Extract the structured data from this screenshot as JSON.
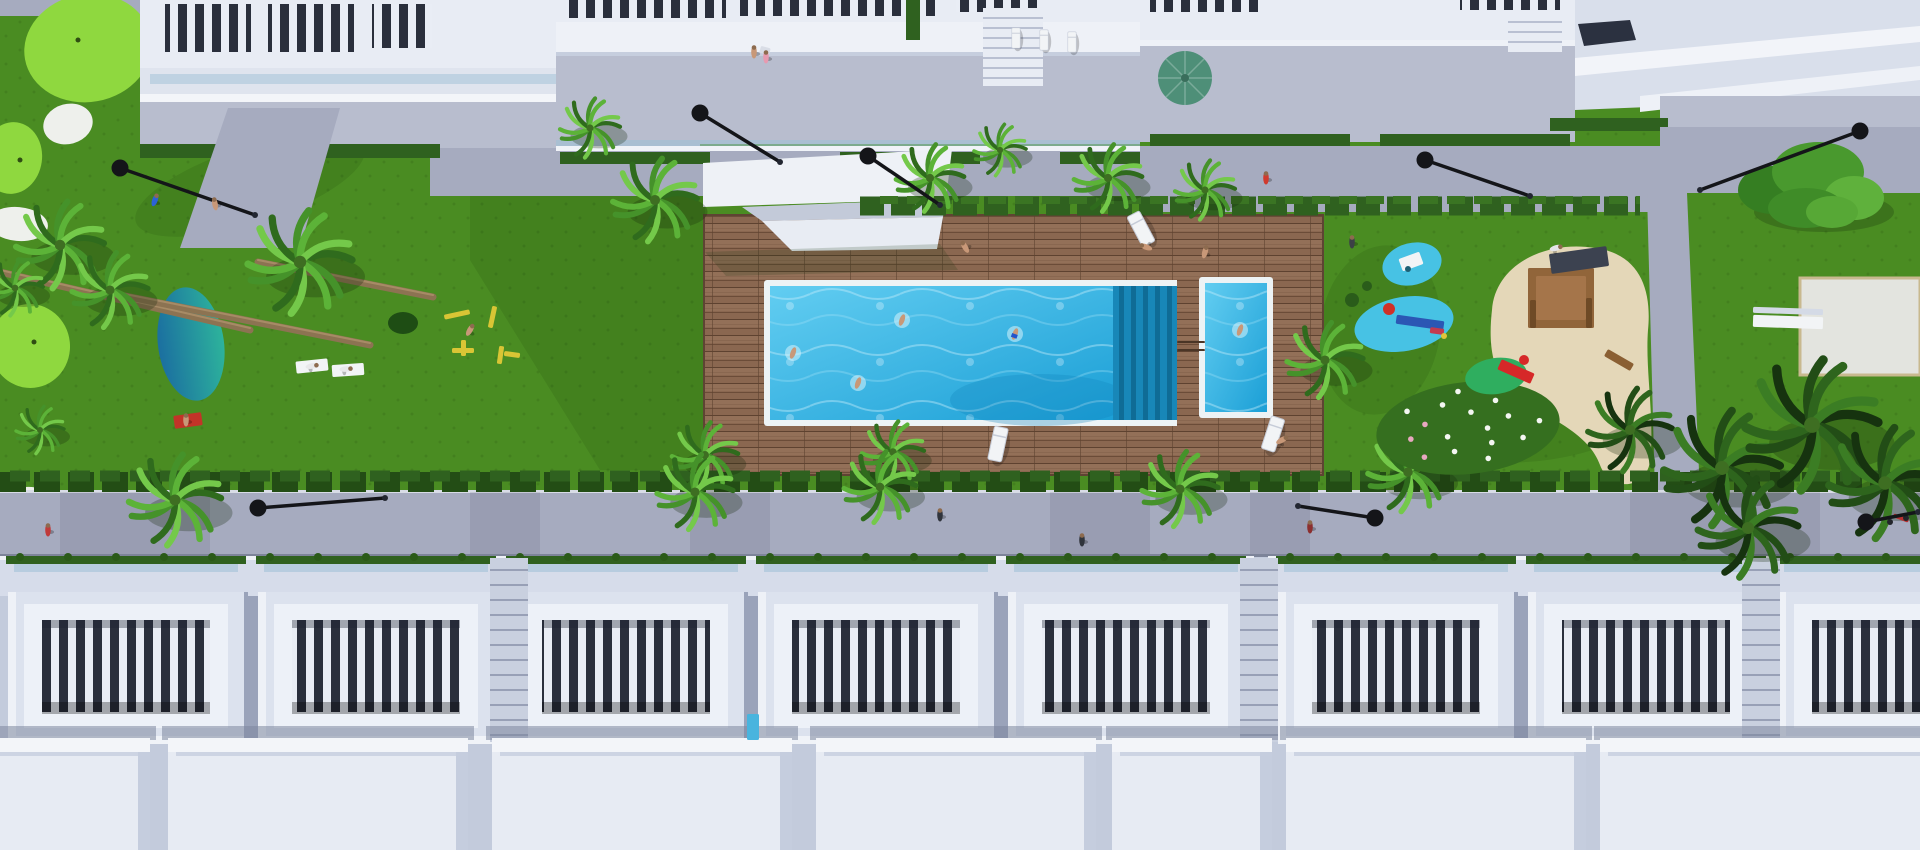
{
  "scene": {
    "description": "Aerial 3D architectural rendering of a white residential resort complex: communal lap pool and kids pool on a wooden deck, lawns with mini-golf, pond, playgrounds, palm trees, street lamps, and rows of townhouse roof terraces",
    "palette": {
      "grass": "#4a8c22",
      "grassDot": "#3c7419",
      "golf": "#8fd83f",
      "golfHole": "#2f4d12",
      "sandWhite": "#eef0ec",
      "pondA": "#2ba898",
      "pondB": "#176e9e",
      "pool": "#2fb0e4",
      "poolDeep": "#1286bd",
      "poolLight": "#aee4f6",
      "rim": "#edf3f5",
      "wood": "#8a6750",
      "woodDark": "#6b4c38",
      "woodLight": "#9c7a60",
      "hedge": "#2f611f",
      "hedgeDark": "#234d15",
      "pave": "#a6abbf",
      "paveLight": "#b8bdce",
      "paveShade": "#8a90a6",
      "bldg": "#e8ecf4",
      "bldgShade": "#c9d0e1",
      "bldgDark": "#99a2ba",
      "slot": "#2a2f3c",
      "glass": "#9fc0d6",
      "sand": "#e4d7b8",
      "woodStruct": "#91653a",
      "lamp": "#141519",
      "umbrella": "#4e8f78",
      "splash": "#47c2e4",
      "mound": "#2fae5f",
      "slide": "#d62828",
      "skin": "#c89878",
      "white": "#f2f4f6",
      "yellow": "#d9c535",
      "red": "#c43a2e"
    },
    "golf": {
      "patches": [
        {
          "x": 88,
          "y": 48,
          "rx": 64,
          "ry": 54,
          "rot": -10
        },
        {
          "x": 12,
          "y": 158,
          "rx": 30,
          "ry": 36,
          "rot": 8
        },
        {
          "x": 30,
          "y": 346,
          "rx": 40,
          "ry": 42,
          "rot": -6
        }
      ],
      "bunkers": [
        {
          "x": 68,
          "y": 124,
          "rx": 25,
          "ry": 20,
          "rot": -15
        },
        {
          "x": 190,
          "y": 98,
          "rx": 33,
          "ry": 22,
          "rot": -8
        },
        {
          "x": 18,
          "y": 224,
          "rx": 30,
          "ry": 17,
          "rot": 5
        },
        {
          "x": 26,
          "y": 502,
          "rx": 27,
          "ry": 15,
          "rot": -4
        }
      ],
      "holes": [
        [
          78,
          40
        ],
        [
          20,
          160
        ],
        [
          34,
          342
        ]
      ]
    },
    "pond": {
      "x": 191,
      "y": 344,
      "rx": 33,
      "ry": 57,
      "rot": -8
    },
    "trunks": [
      [
        0,
        272,
        250,
        330
      ],
      [
        120,
        295,
        370,
        345
      ],
      [
        258,
        262,
        433,
        297
      ]
    ],
    "palms": [
      [
        590,
        128,
        30,
        0
      ],
      [
        655,
        200,
        42,
        0
      ],
      [
        930,
        178,
        34,
        0
      ],
      [
        1000,
        150,
        26,
        0
      ],
      [
        1108,
        178,
        34,
        0
      ],
      [
        1205,
        190,
        30,
        0
      ],
      [
        60,
        245,
        44,
        0
      ],
      [
        110,
        290,
        38,
        0
      ],
      [
        300,
        262,
        52,
        0
      ],
      [
        15,
        288,
        28,
        0
      ],
      [
        40,
        430,
        24,
        0
      ],
      [
        705,
        455,
        33,
        0
      ],
      [
        893,
        452,
        31,
        0
      ],
      [
        1325,
        360,
        38,
        0
      ],
      [
        175,
        500,
        46,
        0
      ],
      [
        695,
        492,
        38,
        0
      ],
      [
        880,
        487,
        36,
        0
      ],
      [
        1180,
        489,
        38,
        0
      ],
      [
        1408,
        472,
        40,
        0
      ],
      [
        1630,
        430,
        42,
        1
      ],
      [
        1722,
        468,
        58,
        1
      ],
      [
        1812,
        425,
        66,
        1
      ],
      [
        1885,
        483,
        56,
        1
      ],
      [
        1748,
        528,
        50,
        1
      ]
    ],
    "trees": [
      [
        1810,
        182
      ]
    ],
    "flowerBush": {
      "x": 1468,
      "y": 428,
      "rx": 92,
      "ry": 46,
      "dots": 16
    },
    "lamps": [
      [
        120,
        168,
        255,
        215
      ],
      [
        700,
        113,
        780,
        162
      ],
      [
        868,
        156,
        940,
        205
      ],
      [
        1425,
        160,
        1530,
        196
      ],
      [
        1860,
        131,
        1700,
        190
      ],
      [
        258,
        508,
        385,
        498
      ],
      [
        1375,
        518,
        1298,
        506
      ],
      [
        1866,
        522,
        1918,
        512
      ]
    ],
    "loungers": [
      [
        1141,
        229,
        -28,
        1
      ],
      [
        1273,
        434,
        18,
        1
      ],
      [
        998,
        444,
        12,
        1
      ],
      [
        1016,
        38,
        0,
        0.6
      ],
      [
        1044,
        40,
        0,
        0.6
      ],
      [
        1072,
        42,
        0,
        0.6
      ]
    ],
    "people": [
      [
        155,
        200,
        "#2c62d6",
        20
      ],
      [
        215,
        204,
        "skin",
        -10
      ],
      [
        312,
        366,
        "#e8e8ea",
        80
      ],
      [
        346,
        369,
        "#e8e8ea",
        85
      ],
      [
        186,
        420,
        "skin",
        0
      ],
      [
        470,
        330,
        "skin",
        30
      ],
      [
        754,
        52,
        "skin",
        0
      ],
      [
        766,
        57,
        "#e79ab0",
        0
      ],
      [
        965,
        247,
        "skin",
        -30
      ],
      [
        1205,
        252,
        "skin",
        15
      ],
      [
        1146,
        247,
        "skin",
        -70
      ],
      [
        1282,
        440,
        "skin",
        60
      ],
      [
        1352,
        242,
        "#3c4046",
        0
      ],
      [
        1556,
        248,
        "#e4e4e8",
        75
      ],
      [
        1266,
        178,
        "#d03a2e",
        0
      ],
      [
        940,
        515,
        "#30343c",
        0
      ],
      [
        1082,
        540,
        "#30343c",
        0
      ],
      [
        1310,
        527,
        "#8c2f2f",
        0
      ],
      [
        48,
        530,
        "#c03a3a",
        0
      ]
    ],
    "swimmers": [
      [
        902,
        320,
        0
      ],
      [
        1015,
        334,
        "#2255cc"
      ],
      [
        793,
        353,
        0
      ],
      [
        858,
        383,
        0
      ],
      [
        1240,
        330,
        0
      ]
    ],
    "props": [
      {
        "t": "ellipse",
        "x": 1412,
        "y": 264,
        "rx": 30,
        "ry": 21,
        "r": -14,
        "f": "splash"
      },
      {
        "t": "rect",
        "x": 1400,
        "y": 255,
        "w": 22,
        "h": 13,
        "r": -20,
        "f": "white"
      },
      {
        "t": "circle",
        "x": 1408,
        "y": 269,
        "rad": 3,
        "f": "#1d5f74"
      },
      {
        "t": "ellipse",
        "x": 1404,
        "y": 324,
        "rx": 50,
        "ry": 27,
        "r": -10,
        "f": "splash"
      },
      {
        "t": "rect",
        "x": 1396,
        "y": 318,
        "w": 48,
        "h": 9,
        "r": 8,
        "f": "#2b57b4"
      },
      {
        "t": "circle",
        "x": 1389,
        "y": 309,
        "rad": 6,
        "f": "#d03028"
      },
      {
        "t": "rect",
        "x": 1430,
        "y": 328,
        "w": 14,
        "h": 6,
        "r": 8,
        "f": "#c23a50"
      },
      {
        "t": "circle",
        "x": 1444,
        "y": 336,
        "rad": 3,
        "f": "#e0c53a"
      },
      {
        "t": "circle",
        "x": 1352,
        "y": 300,
        "rad": 7,
        "f": "#2a5c1a"
      },
      {
        "t": "circle",
        "x": 1367,
        "y": 286,
        "rad": 5,
        "f": "#2a5c1a"
      },
      {
        "t": "ellipse",
        "x": 1496,
        "y": 376,
        "rx": 31,
        "ry": 18,
        "r": -8,
        "f": "mound"
      },
      {
        "t": "rect",
        "x": 1498,
        "y": 366,
        "w": 36,
        "h": 11,
        "r": 24,
        "f": "slide"
      },
      {
        "t": "circle",
        "x": 1524,
        "y": 360,
        "rad": 5,
        "f": "slide"
      },
      {
        "t": "rect",
        "x": 1528,
        "y": 268,
        "w": 66,
        "h": 60,
        "r": 0,
        "f": "woodStruct"
      },
      {
        "t": "rect",
        "x": 1536,
        "y": 276,
        "w": 50,
        "h": 44,
        "r": 0,
        "f": "#a5754a"
      },
      {
        "t": "rect",
        "x": 1550,
        "y": 250,
        "w": 58,
        "h": 20,
        "r": -8,
        "f": "#3c4250"
      },
      {
        "t": "rect",
        "x": 1530,
        "y": 300,
        "w": 6,
        "h": 28,
        "r": 0,
        "f": "#6e4a26"
      },
      {
        "t": "rect",
        "x": 1586,
        "y": 298,
        "w": 6,
        "h": 30,
        "r": 0,
        "f": "#6e4a26"
      },
      {
        "t": "rect",
        "x": 1604,
        "y": 356,
        "w": 30,
        "h": 8,
        "r": 30,
        "f": "#8a5f33"
      },
      {
        "t": "ellipse",
        "x": 403,
        "y": 323,
        "rx": 15,
        "ry": 11,
        "r": 0,
        "f": "#1e4d14"
      },
      {
        "t": "rect",
        "x": 444,
        "y": 312,
        "w": 26,
        "h": 5,
        "r": -12,
        "f": "yellow"
      },
      {
        "t": "rect",
        "x": 490,
        "y": 306,
        "w": 5,
        "h": 22,
        "r": 12,
        "f": "yellow"
      },
      {
        "t": "rect",
        "x": 452,
        "y": 348,
        "w": 22,
        "h": 5,
        "r": 0,
        "f": "yellow"
      },
      {
        "t": "rect",
        "x": 461,
        "y": 340,
        "w": 5,
        "h": 16,
        "r": 0,
        "f": "yellow"
      },
      {
        "t": "rect",
        "x": 498,
        "y": 346,
        "w": 5,
        "h": 18,
        "r": 8,
        "f": "yellow"
      },
      {
        "t": "rect",
        "x": 504,
        "y": 352,
        "w": 16,
        "h": 5,
        "r": 8,
        "f": "yellow"
      },
      {
        "t": "rect",
        "x": 174,
        "y": 414,
        "w": 28,
        "h": 13,
        "r": -8,
        "f": "#c23428"
      },
      {
        "t": "rect",
        "x": 296,
        "y": 360,
        "w": 32,
        "h": 12,
        "r": -6,
        "f": "white"
      },
      {
        "t": "rect",
        "x": 332,
        "y": 364,
        "w": 32,
        "h": 12,
        "r": -4,
        "f": "white"
      },
      {
        "t": "rect",
        "x": 1753,
        "y": 316,
        "w": 70,
        "h": 12,
        "r": 2,
        "f": "white"
      },
      {
        "t": "rect",
        "x": 1753,
        "y": 308,
        "w": 70,
        "h": 6,
        "r": 2,
        "f": "#d4dae6"
      },
      {
        "t": "rect",
        "x": 1893,
        "y": 516,
        "w": 16,
        "h": 4,
        "r": 20,
        "f": "#b93030"
      },
      {
        "t": "circle",
        "x": 1890,
        "y": 522,
        "rad": 3,
        "f": "#23252b"
      },
      {
        "t": "circle",
        "x": 1906,
        "y": 518,
        "rad": 3,
        "f": "#23252b"
      },
      {
        "t": "rect",
        "x": 747,
        "y": 714,
        "w": 12,
        "h": 26,
        "r": 0,
        "f": "#49b4de"
      },
      {
        "t": "rect",
        "x": 760,
        "y": 47,
        "w": 10,
        "h": 7,
        "r": 15,
        "f": "#d9dde6"
      },
      {
        "t": "rect",
        "x": 1177,
        "y": 341,
        "w": 28,
        "h": 2,
        "r": 0,
        "f": "#4a3526"
      },
      {
        "t": "rect",
        "x": 1177,
        "y": 349,
        "w": 28,
        "h": 2,
        "r": 0,
        "f": "#4a3526"
      }
    ],
    "lawnShadows": [
      {
        "pts": "470,150 705,150 705,470 600,470 470,260"
      },
      {
        "x": 250,
        "y": 185,
        "rx": 120,
        "ry": 38,
        "rot": -18
      },
      {
        "x": 1380,
        "y": 330,
        "rx": 60,
        "ry": 85,
        "rot": 8
      },
      {
        "x": 1545,
        "y": 432,
        "rx": 90,
        "ry": 28,
        "rot": -8
      }
    ],
    "pathShadows": [
      [
        60,
        150
      ],
      [
        470,
        70
      ],
      [
        690,
        80
      ],
      [
        1050,
        100
      ],
      [
        1250,
        60
      ],
      [
        1630,
        190
      ]
    ],
    "bottom": {
      "units": [
        8,
        258,
        508,
        758,
        1008,
        1278,
        1528,
        1778
      ],
      "stairs": [
        490,
        1240,
        1742
      ],
      "boxes": [
        [
          -30,
          180
        ],
        [
          168,
          300
        ],
        [
          492,
          300
        ],
        [
          816,
          280
        ],
        [
          1112,
          160
        ],
        [
          1286,
          300
        ],
        [
          1600,
          340
        ]
      ]
    }
  }
}
